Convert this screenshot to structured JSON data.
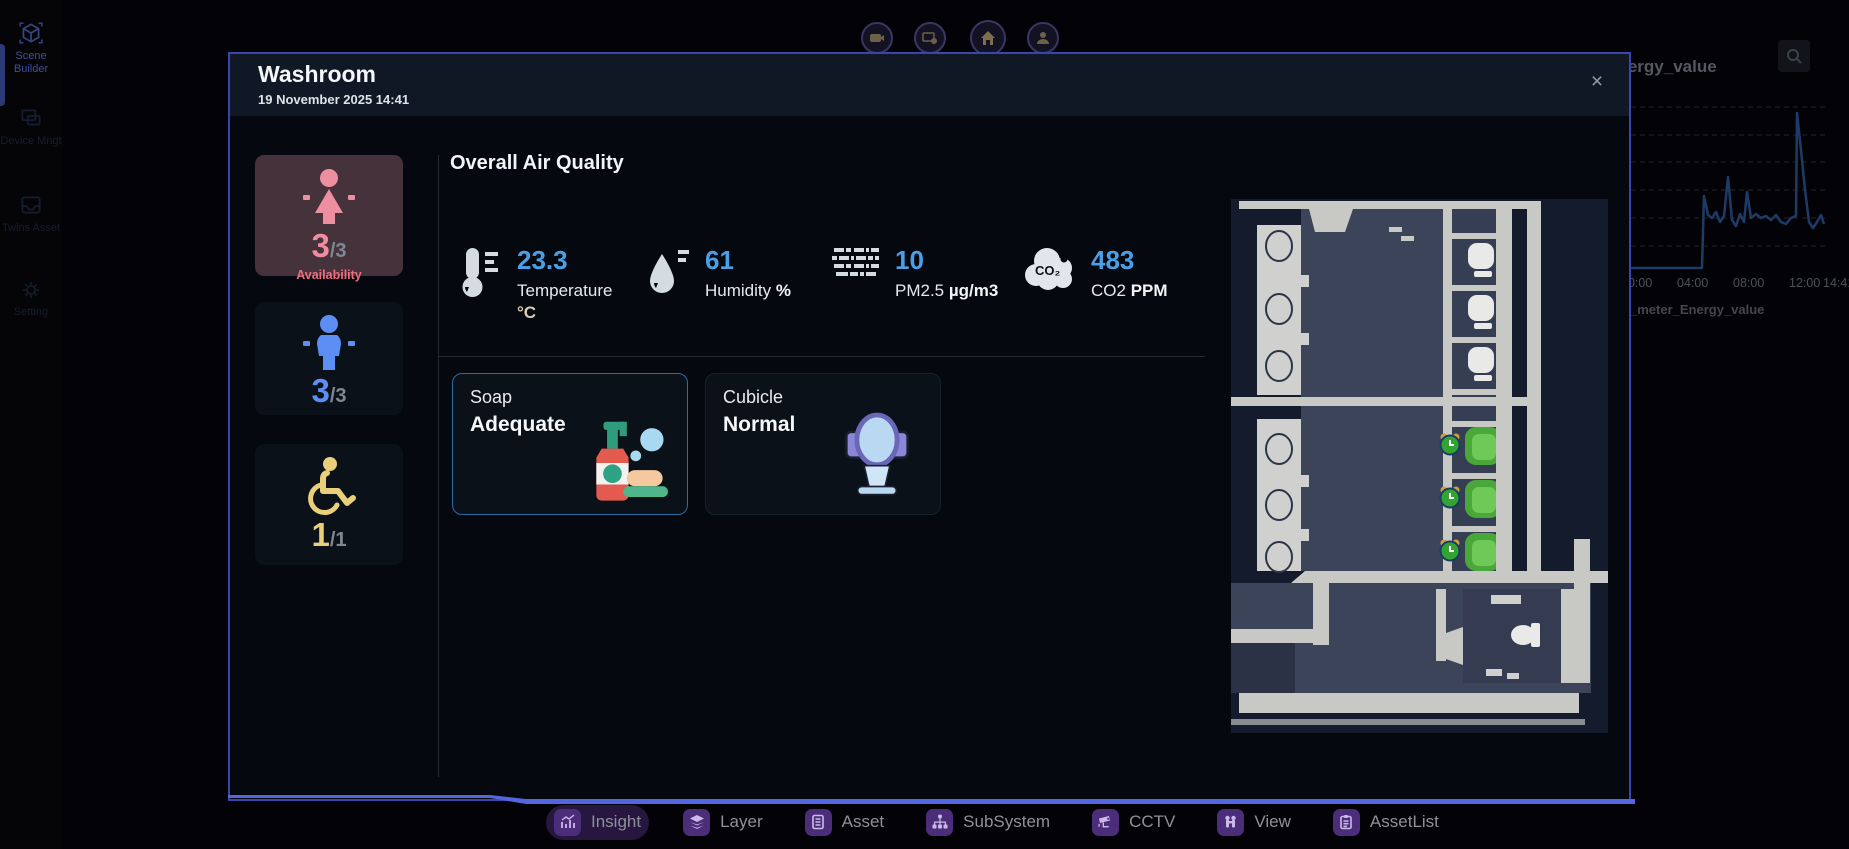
{
  "app": {
    "sidebar": {
      "items": [
        {
          "label": "Scene Builder",
          "icon": "cube-icon",
          "active": true
        },
        {
          "label": "Device Mngt",
          "icon": "device-icon",
          "active": false
        },
        {
          "label": "Twins Asset",
          "icon": "twins-asset-icon",
          "active": false
        },
        {
          "label": "Setting",
          "icon": "gear-icon",
          "active": false
        }
      ]
    },
    "top_buttons": [
      {
        "icon": "camera-icon"
      },
      {
        "icon": "monitor-alert-icon"
      },
      {
        "icon": "home-icon"
      },
      {
        "icon": "user-icon"
      }
    ],
    "toolbar": {
      "items": [
        {
          "label": "Insight",
          "icon": "insight-chart-icon",
          "active": true
        },
        {
          "label": "Layer",
          "icon": "layers-icon",
          "active": false
        },
        {
          "label": "Asset",
          "icon": "asset-icon",
          "active": false
        },
        {
          "label": "SubSystem",
          "icon": "subsystem-icon",
          "active": false
        },
        {
          "label": "CCTV",
          "icon": "cctv-icon",
          "active": false
        },
        {
          "label": "View",
          "icon": "view-icon",
          "active": false
        },
        {
          "label": "AssetList",
          "icon": "assetlist-icon",
          "active": false
        }
      ]
    }
  },
  "modal": {
    "title": "Washroom",
    "datetime": "19 November 2025 14:41",
    "close": "×",
    "tiles": [
      {
        "name": "female",
        "value": "3",
        "total": "/3",
        "caption": "Availability",
        "color": "#ef8da0",
        "bg": "#46323a"
      },
      {
        "name": "male",
        "value": "3",
        "total": "/3",
        "color": "#5d8ef3"
      },
      {
        "name": "accessible",
        "value": "1",
        "total": "/1",
        "color": "#e9cf79"
      }
    ],
    "air": {
      "heading": "Overall Air Quality",
      "value_color": "#4aa0e6",
      "metrics": [
        {
          "icon": "thermometer-icon",
          "value": "23.3",
          "label": "Temperature",
          "unit": "°C"
        },
        {
          "icon": "droplet-icon",
          "value": "61",
          "label": "Humidity",
          "unit": "%"
        },
        {
          "icon": "air-vent-icon",
          "value": "10",
          "label": "PM2.5",
          "unit": "µg/m3"
        },
        {
          "icon": "co2-cloud-icon",
          "icon_text": "CO₂",
          "value": "483",
          "label": "CO2",
          "unit": "PPM"
        }
      ]
    },
    "cards": [
      {
        "title": "Soap",
        "status": "Adequate",
        "icon": "soap-bottle-icon",
        "highlighted": true
      },
      {
        "title": "Cubicle",
        "status": "Normal",
        "icon": "toilet-icon",
        "highlighted": false
      }
    ],
    "floorplan": {
      "sinks": 6,
      "white_stalls": 4,
      "green_stalls": 3,
      "clock_markers": 3
    }
  },
  "background": {
    "panel_title": "energy_value",
    "legend": "_meter_Energy_value",
    "x_ticks": [
      "00:00",
      "04:00",
      "08:00",
      "12:00",
      "14:41"
    ],
    "chart": {
      "points": "0,173 73,173 75,101 79,120 83,123 87,117 91,127 95,121 99,82 103,125 107,131 111,119 115,127 118,97 122,123 127,119 132,123 137,121 142,125 147,120 152,127 157,129 162,123 167,121 168,18 172,55 176,95 180,127 184,133 188,127 192,120 195,129",
      "line_color": "#1e3a66"
    }
  },
  "chart_data": {
    "type": "line",
    "title": "energy_value",
    "x": [
      "00:00",
      "01:00",
      "02:00",
      "03:00",
      "04:00",
      "05:00",
      "05:30",
      "06:00",
      "06:15",
      "06:30",
      "07:00",
      "07:30",
      "08:00",
      "08:30",
      "09:00",
      "10:00",
      "11:00",
      "12:00",
      "12:30",
      "13:00",
      "13:15",
      "13:30",
      "14:00",
      "14:41"
    ],
    "series": [
      {
        "name": "_meter_Energy_value",
        "values": [
          0,
          0,
          0,
          0,
          0,
          0,
          0,
          42,
          30,
          33,
          55,
          28,
          25,
          44,
          27,
          29,
          28,
          30,
          27,
          92,
          70,
          46,
          24,
          27
        ]
      }
    ],
    "x_tick_labels": [
      "00:00",
      "04:00",
      "08:00",
      "12:00",
      "14:41"
    ],
    "ylim": [
      0,
      100
    ],
    "grid": "horizontal-dashed",
    "legend_position": "bottom-left",
    "y_axis_labels_visible": false
  }
}
